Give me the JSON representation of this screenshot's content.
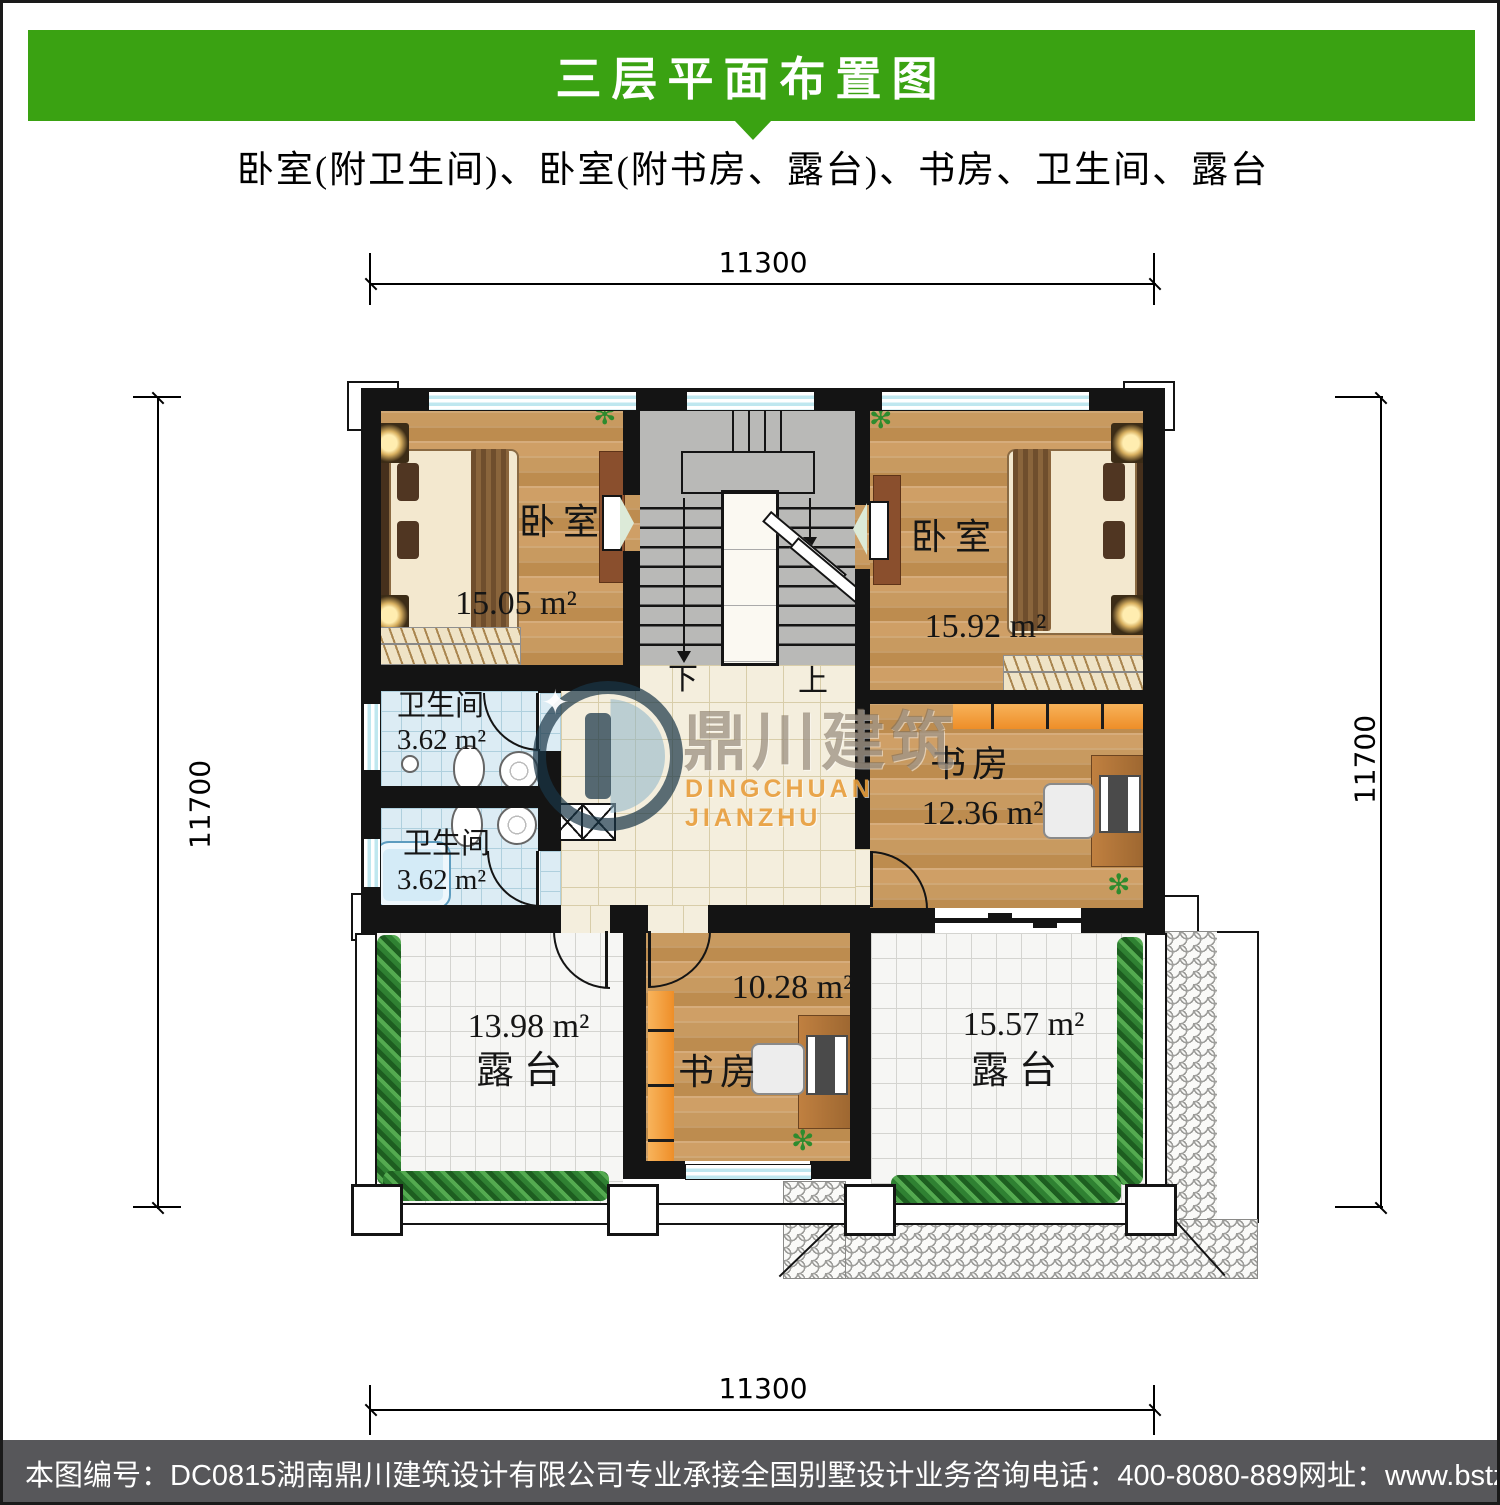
{
  "header": {
    "title": "三层平面布置图",
    "subtitle": "卧室(附卫生间)、卧室(附书房、露台)、书房、卫生间、露台"
  },
  "dims": {
    "top": "11300",
    "bottom": "11300",
    "left": "11700",
    "right": "11700"
  },
  "rooms": {
    "bedroom_left": {
      "name": "卧室",
      "area": "15.05 m²"
    },
    "bedroom_right": {
      "name": "卧室",
      "area": "15.92 m²"
    },
    "bath_upper": {
      "name": "卫生间",
      "area": "3.62 m²"
    },
    "bath_lower": {
      "name": "卫生间",
      "area": "3.62 m²"
    },
    "study_right": {
      "name": "书房",
      "area": "12.36 m²"
    },
    "study_middle": {
      "name": "书房",
      "area": "10.28 m²"
    },
    "terrace_left": {
      "name": "露台",
      "area": "13.98 m²"
    },
    "terrace_right": {
      "name": "露台",
      "area": "15.57 m²"
    }
  },
  "stairs": {
    "down_label": "下",
    "up_label": "上"
  },
  "watermark": {
    "name_cn": "鼎川建筑",
    "name_en": "DINGCHUAN JIANZHU"
  },
  "footer": {
    "drawing_no": "本图编号：DC0815",
    "company": "湖南鼎川建筑设计有限公司专业承接全国别墅设计业务",
    "phone": "咨询电话：400-8080-889",
    "website": "网址：www.bstzcs.com"
  },
  "colors": {
    "banner_green": "#3aa212",
    "footer_gray": "#57575a",
    "wall_black": "#141414",
    "window_cyan": "#bfe7ef",
    "shelf_orange": "#f29a38",
    "watermark_orange": "#e89e3c"
  }
}
